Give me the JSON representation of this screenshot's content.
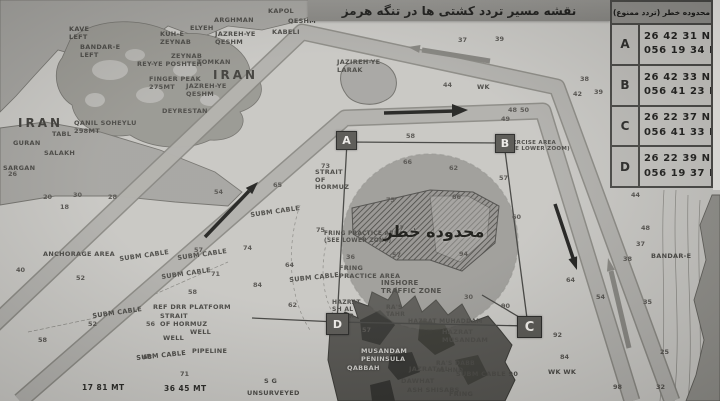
{
  "header": {
    "title": "نقشه مسیر تردد کشتی ها در تنگه هرمز"
  },
  "coords_table": {
    "title": "محدوده خطر (تردد ممنوع)",
    "rows": [
      {
        "point": "A",
        "lat": "26 42 31 N",
        "lon": "056 19 34 E"
      },
      {
        "point": "B",
        "lat": "26 42 33 N",
        "lon": "056 41 23 E"
      },
      {
        "point": "C",
        "lat": "26 22 37 N",
        "lon": "056 41 33 E"
      },
      {
        "point": "D",
        "lat": "26 22 39 N",
        "lon": "056 19 37 E"
      }
    ]
  },
  "danger_zone": {
    "label": "محدوده خطر",
    "corner_markers": [
      "A",
      "B",
      "C",
      "D"
    ]
  },
  "map": {
    "labels": [
      {
        "t": "KAPOL",
        "x": 268,
        "y": 8
      },
      {
        "t": "QESHM",
        "x": 288,
        "y": 18
      },
      {
        "t": "KABELI",
        "x": 272,
        "y": 29
      },
      {
        "t": "ARGHMAN",
        "x": 214,
        "y": 17
      },
      {
        "t": "ELYEH",
        "x": 190,
        "y": 25
      },
      {
        "t": "KUH-E\nZEYNAB",
        "x": 160,
        "y": 31
      },
      {
        "t": "JAZREH-YE\nQESHM",
        "x": 215,
        "y": 31
      },
      {
        "t": "ZEYNAB",
        "x": 171,
        "y": 53
      },
      {
        "t": "TOMKAN",
        "x": 197,
        "y": 59
      },
      {
        "t": "REY-YE POSHTEH",
        "x": 137,
        "y": 61
      },
      {
        "t": "BANDAR-E\nLEFT",
        "x": 80,
        "y": 44
      },
      {
        "t": "KAVE\nLEFT",
        "x": 69,
        "y": 26
      },
      {
        "t": "IRAN",
        "x": 213,
        "y": 68,
        "c": "big"
      },
      {
        "t": "FINGER PEAK\n275MT",
        "x": 149,
        "y": 76
      },
      {
        "t": "JAZREH-YE\nQESHM",
        "x": 186,
        "y": 83
      },
      {
        "t": "DEYRESTAN",
        "x": 162,
        "y": 108
      },
      {
        "t": "QANIL SOHEYLU\n298MT",
        "x": 74,
        "y": 120
      },
      {
        "t": "IRAN",
        "x": 18,
        "y": 116,
        "c": "big"
      },
      {
        "t": "GURAN",
        "x": 13,
        "y": 140
      },
      {
        "t": "TABL",
        "x": 52,
        "y": 131
      },
      {
        "t": "SALAKH",
        "x": 44,
        "y": 150
      },
      {
        "t": "SARGAN",
        "x": 3,
        "y": 165
      },
      {
        "t": "JAZIREH-YE\nLARAK",
        "x": 337,
        "y": 59
      },
      {
        "t": "STRAIT\nOF\nHORMUZ",
        "x": 315,
        "y": 169
      },
      {
        "t": "SUBM CABLE",
        "x": 250,
        "y": 212,
        "r": -8
      },
      {
        "t": "SUBM CABLE",
        "x": 119,
        "y": 256,
        "r": -8
      },
      {
        "t": "SUBM CABLE",
        "x": 177,
        "y": 255,
        "r": -8
      },
      {
        "t": "SUBM CABLE",
        "x": 161,
        "y": 274,
        "r": -8
      },
      {
        "t": "SUBM CABLE",
        "x": 92,
        "y": 313,
        "r": -8
      },
      {
        "t": "SUBM CABLE",
        "x": 289,
        "y": 277,
        "r": -6
      },
      {
        "t": "SUBM CABLE",
        "x": 136,
        "y": 355,
        "r": -6
      },
      {
        "t": "SUBM CABLE 90",
        "x": 456,
        "y": 371
      },
      {
        "t": "ANCHORAGE AREA",
        "x": 43,
        "y": 251
      },
      {
        "t": "REF DRR PLATFORM",
        "x": 153,
        "y": 304
      },
      {
        "t": "STRAIT\nOF HORMUZ",
        "x": 160,
        "y": 313
      },
      {
        "t": "WELL",
        "x": 163,
        "y": 335
      },
      {
        "t": "WELL",
        "x": 190,
        "y": 329
      },
      {
        "t": "PIPELINE",
        "x": 192,
        "y": 348
      },
      {
        "t": "FRING PRACTICE AREA\n(SEE LOWER ZONE)",
        "x": 324,
        "y": 231,
        "s": 5.8
      },
      {
        "t": "FRING\nPRACTICE AREA",
        "x": 339,
        "y": 265
      },
      {
        "t": "INSHORE\nTRAFFIC ZONE",
        "x": 381,
        "y": 279,
        "s": 7
      },
      {
        "t": "EXERCISE AREA\n(SEE LOWER ZOOM)",
        "x": 504,
        "y": 140,
        "s": 5.5
      },
      {
        "t": "HAZRAT\nSH AL\nKABIR",
        "x": 332,
        "y": 299,
        "s": 6
      },
      {
        "t": "RA'S\nTAHR",
        "x": 386,
        "y": 304,
        "s": 6
      },
      {
        "t": "HAZRAT MUHADDAM",
        "x": 408,
        "y": 318,
        "s": 6
      },
      {
        "t": "HAZRAT\nMUSANDAM",
        "x": 442,
        "y": 329
      },
      {
        "t": "MUSANDAM\nPENINSULA",
        "x": 361,
        "y": 348,
        "c": "light"
      },
      {
        "t": "QABBAH",
        "x": 347,
        "y": 365,
        "c": "light"
      },
      {
        "t": "JAZRAT AL",
        "x": 409,
        "y": 366
      },
      {
        "t": "DAWHAT",
        "x": 401,
        "y": 378
      },
      {
        "t": "ASH SHISABS",
        "x": 407,
        "y": 387
      },
      {
        "t": "RA'S DABB\nAL HND",
        "x": 436,
        "y": 360,
        "s": 6
      },
      {
        "t": "FRING",
        "x": 449,
        "y": 391
      },
      {
        "t": "UNSURVEYED",
        "x": 247,
        "y": 390
      },
      {
        "t": "S G",
        "x": 264,
        "y": 378
      },
      {
        "t": "BANDAR-E",
        "x": 651,
        "y": 253
      },
      {
        "t": "WK",
        "x": 477,
        "y": 84
      },
      {
        "t": "WK WK",
        "x": 548,
        "y": 369
      },
      {
        "t": "17 81 MT",
        "x": 82,
        "y": 384,
        "c": "bold"
      },
      {
        "t": "36 45 MT",
        "x": 164,
        "y": 385,
        "c": "bold"
      }
    ],
    "soundings": [
      [
        58,
        406,
        132
      ],
      [
        66,
        403,
        158
      ],
      [
        62,
        449,
        164
      ],
      [
        57,
        499,
        174
      ],
      [
        75,
        386,
        196
      ],
      [
        66,
        452,
        193
      ],
      [
        60,
        512,
        213
      ],
      [
        27,
        395,
        224
      ],
      [
        57,
        392,
        251
      ],
      [
        94,
        459,
        250
      ],
      [
        36,
        346,
        253
      ],
      [
        30,
        464,
        293
      ],
      [
        90,
        501,
        302
      ],
      [
        57,
        362,
        326
      ],
      [
        73,
        321,
        162
      ],
      [
        54,
        214,
        188
      ],
      [
        65,
        273,
        181
      ],
      [
        75,
        316,
        226
      ],
      [
        74,
        243,
        244
      ],
      [
        71,
        211,
        270
      ],
      [
        84,
        253,
        281
      ],
      [
        64,
        285,
        261
      ],
      [
        62,
        288,
        301
      ],
      [
        57,
        194,
        246
      ],
      [
        58,
        188,
        288
      ],
      [
        52,
        88,
        320
      ],
      [
        56,
        146,
        320
      ],
      [
        40,
        16,
        266
      ],
      [
        52,
        76,
        274
      ],
      [
        58,
        38,
        336
      ],
      [
        68,
        143,
        353
      ],
      [
        71,
        180,
        370
      ],
      [
        44,
        631,
        191
      ],
      [
        48,
        641,
        224
      ],
      [
        37,
        636,
        240
      ],
      [
        38,
        623,
        255
      ],
      [
        35,
        643,
        298
      ],
      [
        25,
        660,
        348
      ],
      [
        32,
        656,
        383
      ],
      [
        38,
        580,
        75
      ],
      [
        39,
        594,
        88
      ],
      [
        42,
        573,
        90
      ],
      [
        37,
        458,
        36
      ],
      [
        39,
        495,
        35
      ],
      [
        44,
        443,
        81
      ],
      [
        48,
        508,
        106
      ],
      [
        50,
        520,
        106
      ],
      [
        49,
        501,
        115
      ],
      [
        64,
        566,
        276
      ],
      [
        54,
        596,
        293
      ],
      [
        92,
        553,
        331
      ],
      [
        84,
        560,
        353
      ],
      [
        98,
        613,
        383
      ],
      [
        20,
        43,
        193
      ],
      [
        30,
        73,
        191
      ],
      [
        26,
        8,
        170
      ],
      [
        28,
        108,
        193
      ],
      [
        18,
        60,
        203
      ]
    ]
  },
  "colors": {
    "sea": "#c6c5c1",
    "lane_fill": "#b0afab",
    "lane_edge": "#817f7a",
    "land": "#a09f9b",
    "dark_terrain": "#504f4b",
    "bar": "#8b8a86",
    "danger_circle_fill": "#62615c",
    "marker_bg": "#53524e"
  }
}
